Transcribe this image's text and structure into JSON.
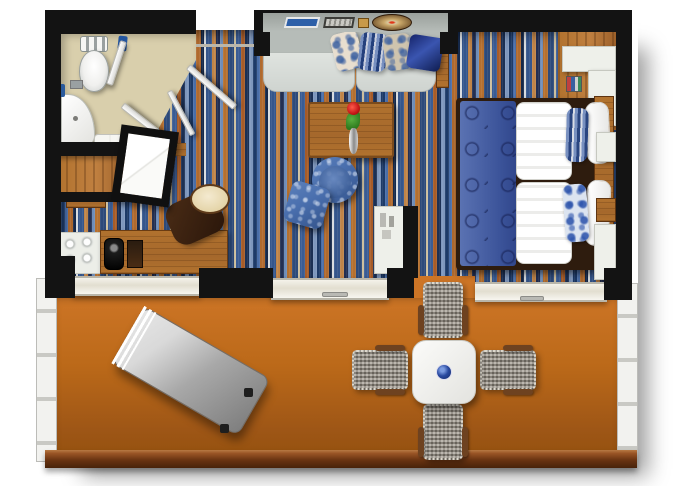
{
  "app": {
    "name": "hotel-suite-floor-plan",
    "kind": "top-down rendered floor plan, no visible text"
  },
  "palette": {
    "wall": "#131313",
    "bath_floor": "#d9cfac",
    "balcony_top": "#cd7526",
    "balcony_mid": "#bb6919",
    "balcony_bottom": "#9e5616",
    "rail_wood_hi": "#9a5526",
    "rail_wood_lo": "#48220a",
    "wood": "#b1722e",
    "wood_dark": "#7d4a1c",
    "white_furn": "#eef0ea",
    "sofa_back": "#b6bcb8",
    "sofa_seat": "#dfe3df",
    "damask_blue": "#4a6fae",
    "damask_deep": "#24407c",
    "runner_blue": "#4a63a8",
    "runner_swirl": "#1c2c5e",
    "navy_pillow": "#1a2a6e",
    "wicker": "#968f83",
    "lounger_hi": "#d9d9d9",
    "lounger_lo": "#7e7e7e",
    "rose_red": "#c41616",
    "leaf_green": "#2e7a1e",
    "accent_blue": "#2a5a9c"
  },
  "carpet_stripes": [
    {
      "c": "#1d3a68",
      "w": 4
    },
    {
      "c": "#4a6ea8",
      "w": 3
    },
    {
      "c": "#b06a2e",
      "w": 5
    },
    {
      "c": "#16294a",
      "w": 3
    },
    {
      "c": "#d8dce0",
      "w": 2
    },
    {
      "c": "#35568c",
      "w": 6
    },
    {
      "c": "#c08448",
      "w": 4
    },
    {
      "c": "#232f52",
      "w": 4
    },
    {
      "c": "#6f8db8",
      "w": 3
    },
    {
      "c": "#b5702f",
      "w": 5
    },
    {
      "c": "#2d4a7a",
      "w": 6
    },
    {
      "c": "#cdbf9e",
      "w": 2
    },
    {
      "c": "#3a5c94",
      "w": 5
    },
    {
      "c": "#a85c28",
      "w": 4
    },
    {
      "c": "#1c3054",
      "w": 4
    },
    {
      "c": "#7e97bd",
      "w": 4
    }
  ],
  "rooms": {
    "bathroom": {
      "label": "Bathroom"
    },
    "entry": {
      "label": "Entry"
    },
    "living": {
      "label": "Living area"
    },
    "bedroom": {
      "label": "Bedroom"
    },
    "balcony": {
      "label": "Balcony"
    }
  },
  "furniture": {
    "toilet": {
      "label": "Toilet"
    },
    "vanity": {
      "label": "Bathroom vanity"
    },
    "closet": {
      "label": "Closet"
    },
    "mirror_panel": {
      "label": "Mirror panel"
    },
    "desk": {
      "label": "Desk with coffee machine"
    },
    "desk_chair": {
      "label": "Desk chair"
    },
    "cups": {
      "label": "Cup tray"
    },
    "sofa": {
      "label": "Sofa with four pillows"
    },
    "ledge": {
      "label": "Decor ledge with trays"
    },
    "coffee_table": {
      "label": "Coffee table with rose"
    },
    "armchair": {
      "label": "Round blue armchair"
    },
    "ottoman": {
      "label": "Blue ottoman"
    },
    "minibar": {
      "label": "Minibar cabinet"
    },
    "bed": {
      "label": "Double bed with blue runner"
    },
    "nightstand": {
      "label": "Nightstand"
    },
    "corner_cabinet": {
      "label": "Corner cabinet"
    },
    "dining_table": {
      "label": "Balcony dining table"
    },
    "dining_chair": {
      "label": "Wicker chair"
    },
    "lounger": {
      "label": "Sun lounger"
    }
  }
}
